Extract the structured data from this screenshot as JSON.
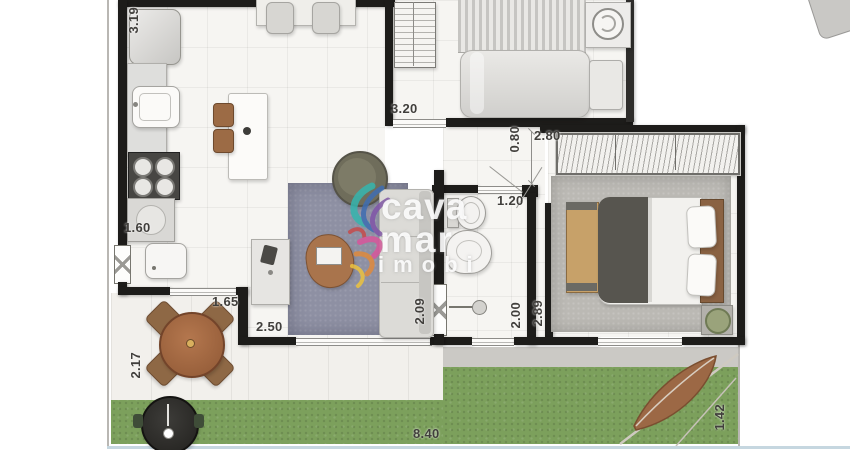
{
  "watermark": {
    "line1": "cava",
    "line2": "mar",
    "line3": "imobi"
  },
  "measurements": {
    "kitchen_depth": "3.19",
    "bedroom1_width": "3.20",
    "hall_width": "0.80",
    "bedroom2_width": "2.80",
    "bathroom_door_width": "1.20",
    "service_width": "1.60",
    "service_door_width": "1.65",
    "living_width": "2.50",
    "living_depth": "2.09",
    "bathroom_depth": "2.00",
    "bedroom2_depth": "2.89",
    "terrace_depth": "2.17",
    "garden_width": "8.40",
    "garden_depth": "1.42"
  },
  "colors": {
    "wall": "#1d1c1a",
    "floor": "#f6f5f2",
    "grass": "#7ca05c",
    "walkway": "#cbc9c5",
    "living_rug": "#8e90a3",
    "bedroom_rug": "#bbb9b4",
    "wood_table": "#a9663d",
    "bottom_edge": "#c6d7e0"
  }
}
